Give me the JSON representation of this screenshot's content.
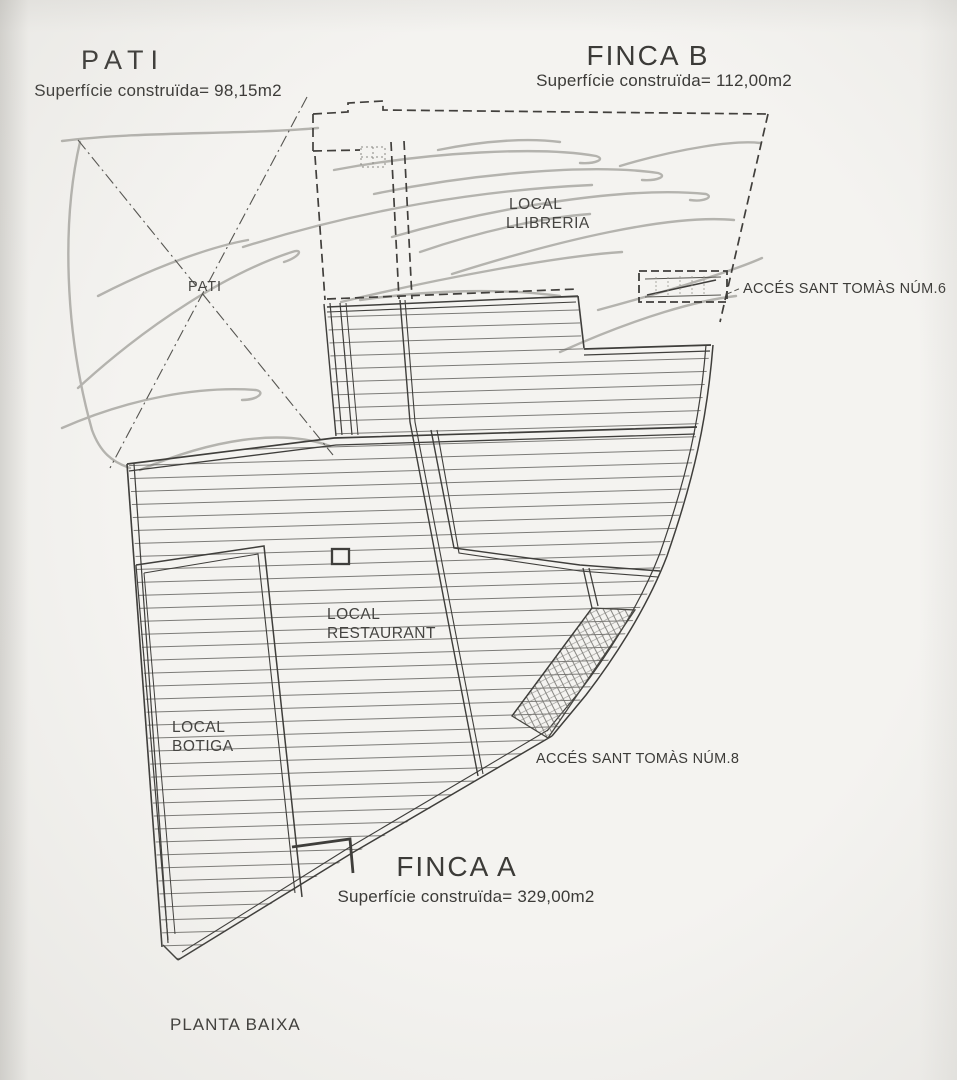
{
  "drawing": {
    "sheet_label": "PLANTA BAIXA"
  },
  "pati": {
    "title": "PATI",
    "area": "Superfície construïda= 98,15m2",
    "zone_label": "PATI"
  },
  "finca_b": {
    "title": "FINCA B",
    "area": "Superfície construïda= 112,00m2",
    "local_line1": "LOCAL",
    "local_line2": "LLIBRERIA",
    "access": "ACCÉS SANT TOMÀS NÚM.6"
  },
  "finca_a": {
    "title": "FINCA A",
    "area": "Superfície construïda= 329,00m2",
    "restaurant_line1": "LOCAL",
    "restaurant_line2": "RESTAURANT",
    "botiga_line1": "LOCAL",
    "botiga_line2": "BOTIGA",
    "access": "ACCÉS SANT TOMÀS NÚM.8"
  },
  "colors": {
    "paper": "#f4f3f0",
    "ink": "#3f3e3b",
    "pencil": "#a9a8a3",
    "hatch": "#6e6d6a"
  }
}
